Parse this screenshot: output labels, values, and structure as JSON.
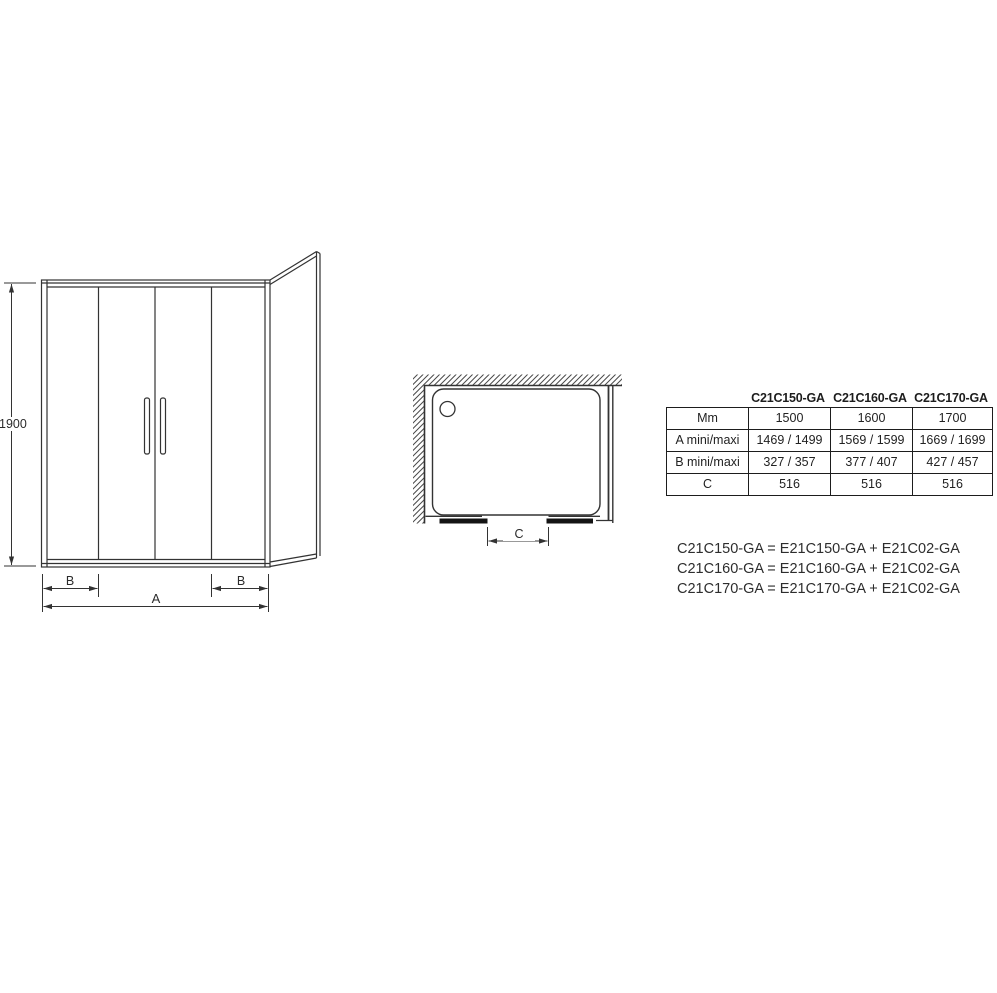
{
  "front_view": {
    "height_label": "1900",
    "width_label": "A",
    "b_left_label": "B",
    "b_right_label": "B"
  },
  "plan_view": {
    "opening_label": "C"
  },
  "table": {
    "column_headers": [
      "C21C150-GA",
      "C21C160-GA",
      "C21C170-GA"
    ],
    "rows": [
      {
        "label": "Mm",
        "values": [
          "1500",
          "1600",
          "1700"
        ]
      },
      {
        "label": "A mini/maxi",
        "values": [
          "1469 / 1499",
          "1569 / 1599",
          "1669 / 1699"
        ]
      },
      {
        "label": "B mini/maxi",
        "values": [
          "327 / 357",
          "377 / 407",
          "427 / 457"
        ]
      },
      {
        "label": "C",
        "values": [
          "516",
          "516",
          "516"
        ]
      }
    ]
  },
  "formulas": [
    "C21C150-GA = E21C150-GA + E21C02-GA",
    "C21C160-GA = E21C160-GA + E21C02-GA",
    "C21C170-GA = E21C170-GA + E21C02-GA"
  ],
  "colors": {
    "line": "#333333",
    "table_border": "#1d1d1d",
    "door_fill": "#141414",
    "text": "#2b2b2b"
  }
}
